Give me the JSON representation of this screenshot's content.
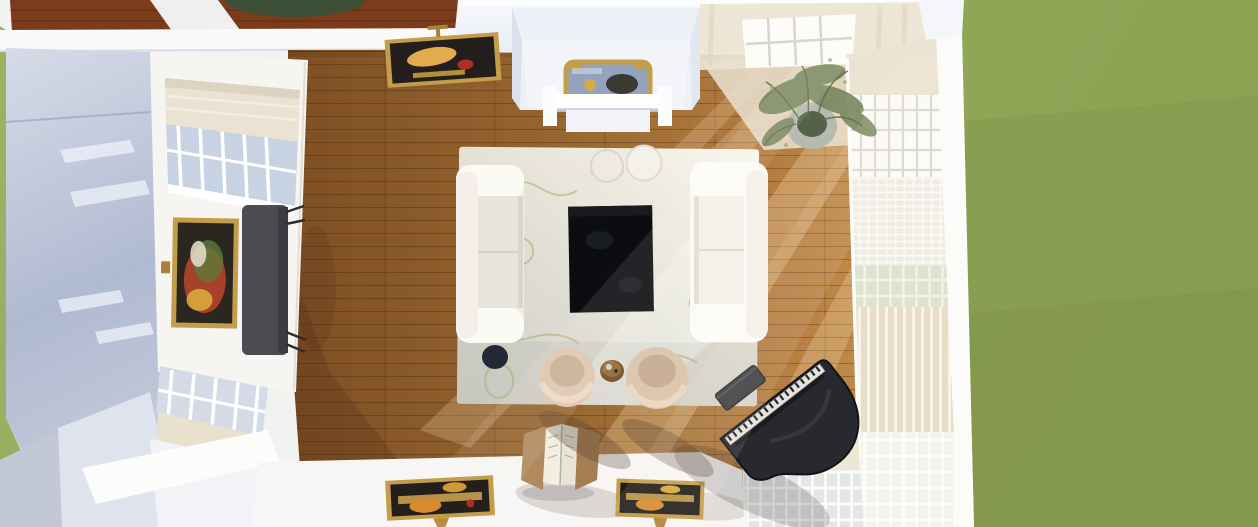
{
  "scene": {
    "type": "3d-render-top-down",
    "description": "Bird's-eye 3D render of a living room: hardwood floor, white sofas facing a black coffee table on a pale botanical rug, two beige barrel armchairs, black grand piano with bench, fireplace with gilt mirror, gilt-framed vintage posters, console desk, potted plant, window walls with sheer curtains, lawn outside",
    "objects": [
      "lawn",
      "upper-room-floor",
      "round-green-rug",
      "flat-roof-left",
      "hardwood-floor",
      "fireplace-chimney",
      "gilt-mirror",
      "mantel-shelf",
      "poster-top-wall",
      "sheer-curtains",
      "corner-plant",
      "right-window-wall",
      "left-wall-window",
      "poster-left-wall",
      "console-desk",
      "area-rug",
      "sofa-left",
      "sofa-right",
      "coffee-table",
      "round-side-table-small",
      "round-side-table-large",
      "ottoman",
      "armchair-left",
      "armchair-right",
      "between-chairs-table",
      "grand-piano",
      "piano-bench",
      "bottom-wall-window",
      "poster-bottom-left",
      "poster-bottom-right",
      "open-book-stand"
    ]
  },
  "colors": {
    "grass": "#96aa5c",
    "grassDark": "#87994e",
    "upperFloor": "#7c3b1b",
    "upperRug": "#3d4f36",
    "roofMid": "#b0bad1",
    "wallWhite": "#f2f2f0",
    "wallTint": "#e9ecf4",
    "floorMid": "#96652f",
    "floorLight": "#c9964f",
    "rugBase": "#cecdc5",
    "rugLight": "#f8f6ee",
    "rugVein": "#a8ac72",
    "sofa": "#efede5",
    "sofaBright": "#fbfaf5",
    "cushion": "#e7e4da",
    "coffeeTable": "#0b0d11",
    "armchair": "#ddc7b0",
    "armchairSeat": "#c9b097",
    "ottoman": "#232834",
    "tableWood": "#7e5a33",
    "piano": "#27292e",
    "pianoDark": "#121317",
    "pianoKeys": "#e6e3dc",
    "gold": "#c49d4b",
    "goldDark": "#a8813a",
    "posterDark": "#241f1c",
    "posterYellow": "#e3aa4e",
    "posterOrange": "#d98a2c",
    "posterRed": "#a93126",
    "mirrorGlass": "#93a3bd",
    "curtain": "#ece4d2",
    "curtainShade": "#e0d6c0",
    "windowGlass": "#dfe3e2",
    "windowGridGray": "#d8d5ce",
    "plantGreen": "#74845c",
    "plantDark": "#55624a",
    "plantPot": "#b6bab0",
    "deskGray": "#4b4c50"
  }
}
